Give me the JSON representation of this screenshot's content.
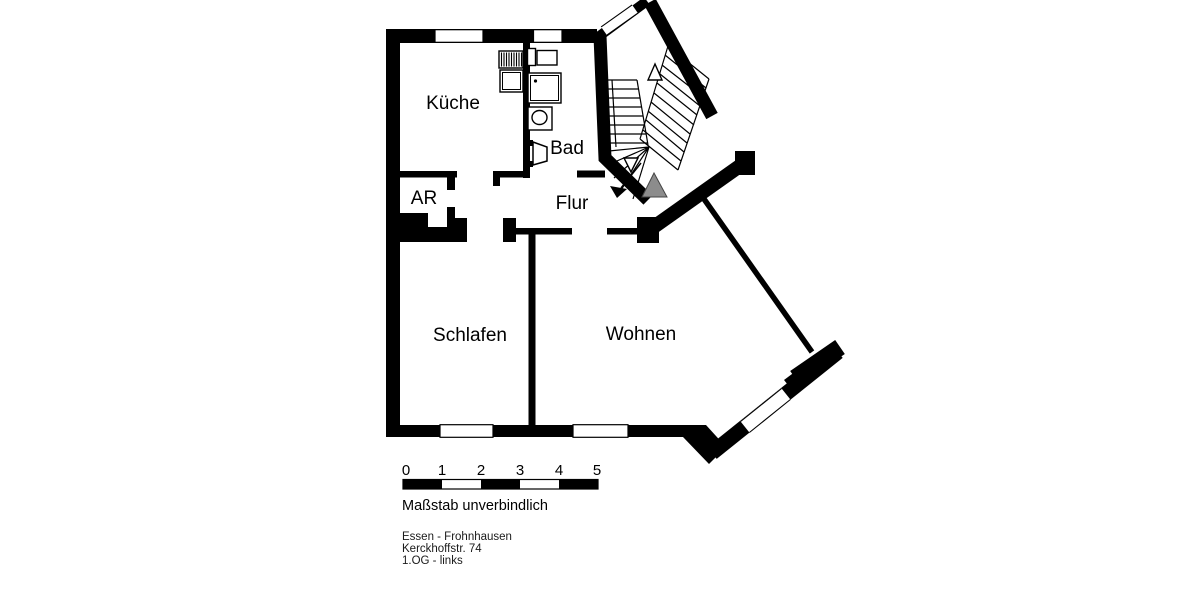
{
  "plan": {
    "title": "Grundriss Wohnung",
    "rooms": {
      "kueche": "Küche",
      "bad": "Bad",
      "ar": "AR",
      "flur": "Flur",
      "schlafen": "Schlafen",
      "wohnen": "Wohnen"
    },
    "icons": {
      "kitchen": [
        "sink-drainer-icon",
        "stove-icon"
      ],
      "bathroom": [
        "washbasin-icon",
        "shower-icon",
        "toilet-icon",
        "bathroom-door-icon"
      ],
      "stairwell": [
        "stairs-icon",
        "stair-up-arrow-icon",
        "stair-down-arrow-icon",
        "entrance-marker-icon"
      ]
    }
  },
  "scale_bar": {
    "ticks": [
      "0",
      "1",
      "2",
      "3",
      "4",
      "5"
    ],
    "caption": "Maßstab unverbindlich"
  },
  "address": {
    "city": "Essen - Frohnhausen",
    "street": "Kerckhoffstr. 74",
    "floor": "1.OG - links"
  },
  "colors": {
    "wall": "#000000",
    "background": "#ffffff",
    "entrance_marker": "#8c8c8c"
  }
}
